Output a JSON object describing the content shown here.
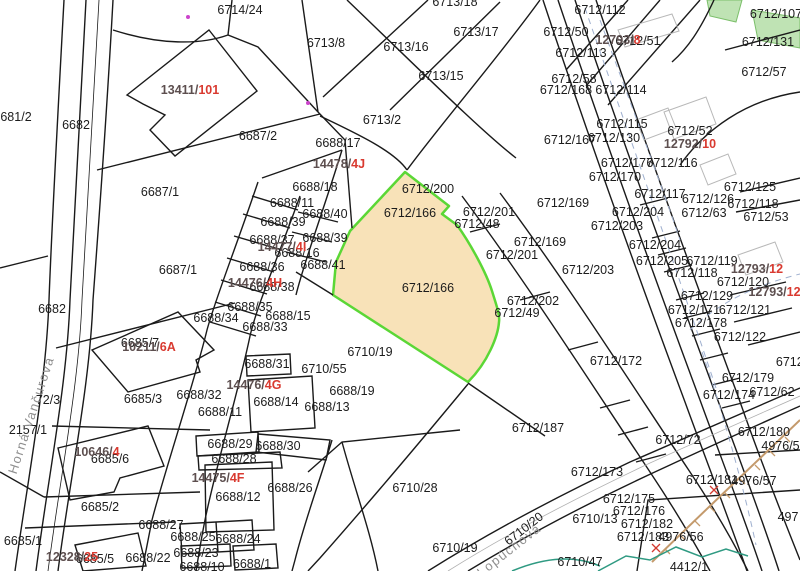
{
  "map": {
    "type": "cadastral-map",
    "highlighted_parcel": {
      "number": "6712/166",
      "fill": "#f8e2b8",
      "border": "#5bd736"
    },
    "colors": {
      "parcel_label": "#1c1c1c",
      "building_label_prefix": "#5d4f4f",
      "building_label_suffix": "#d93a30",
      "street_label": "#8f8f8f",
      "boundary_line": "#1a1a1a",
      "vegetation_fill": "#bfe3b4",
      "road_marking": "#9fb0cf",
      "slope_line": "#c49a6c",
      "utility_line": "#2f9a82"
    },
    "streets": [
      {
        "name": "Horná Vančurova",
        "x": 31,
        "y": 415,
        "rot": -72
      },
      {
        "name": "Lopúchová",
        "x": 509,
        "y": 550,
        "rot": -38
      }
    ],
    "parcel_labels": [
      {
        "text": "6714/24",
        "x": 240,
        "y": 10
      },
      {
        "text": "681/2",
        "x": 16,
        "y": 117
      },
      {
        "text": "6682",
        "x": 76,
        "y": 125
      },
      {
        "text": "6682",
        "x": 52,
        "y": 309
      },
      {
        "text": "6687/2",
        "x": 258,
        "y": 136
      },
      {
        "text": "6687/1",
        "x": 160,
        "y": 192
      },
      {
        "text": "6687/1",
        "x": 178,
        "y": 270
      },
      {
        "text": "6713/8",
        "x": 326,
        "y": 43
      },
      {
        "text": "6713/16",
        "x": 406,
        "y": 47
      },
      {
        "text": "6713/17",
        "x": 476,
        "y": 32
      },
      {
        "text": "6713/15",
        "x": 441,
        "y": 76
      },
      {
        "text": "6713/2",
        "x": 382,
        "y": 120
      },
      {
        "text": "6713/18",
        "x": 455,
        "y": 2
      },
      {
        "text": "6688/17",
        "x": 338,
        "y": 143
      },
      {
        "text": "6688/18",
        "x": 315,
        "y": 187
      },
      {
        "text": "6688/11",
        "x": 292,
        "y": 203
      },
      {
        "text": "6688/40",
        "x": 325,
        "y": 214
      },
      {
        "text": "6688/39",
        "x": 283,
        "y": 222
      },
      {
        "text": "6688/37",
        "x": 272,
        "y": 240
      },
      {
        "text": "6688/39",
        "x": 325,
        "y": 238
      },
      {
        "text": "6688/16",
        "x": 297,
        "y": 253
      },
      {
        "text": "6688/36",
        "x": 262,
        "y": 267
      },
      {
        "text": "6688/41",
        "x": 323,
        "y": 265
      },
      {
        "text": "6688/38",
        "x": 272,
        "y": 287
      },
      {
        "text": "6688/35",
        "x": 250,
        "y": 307
      },
      {
        "text": "6688/34",
        "x": 216,
        "y": 318
      },
      {
        "text": "6688/15",
        "x": 288,
        "y": 316
      },
      {
        "text": "6688/33",
        "x": 265,
        "y": 327
      },
      {
        "text": "6712/200",
        "x": 428,
        "y": 189
      },
      {
        "text": "6712/166",
        "x": 410,
        "y": 213
      },
      {
        "text": "6712/166",
        "x": 428,
        "y": 288
      },
      {
        "text": "6712/167",
        "x": 570,
        "y": 140
      },
      {
        "text": "6712/201",
        "x": 489,
        "y": 212
      },
      {
        "text": "6712/48",
        "x": 477,
        "y": 224
      },
      {
        "text": "6712/169",
        "x": 563,
        "y": 203
      },
      {
        "text": "6712/169",
        "x": 540,
        "y": 242
      },
      {
        "text": "6712/201",
        "x": 512,
        "y": 255
      },
      {
        "text": "6712/203",
        "x": 617,
        "y": 226
      },
      {
        "text": "6712/203",
        "x": 588,
        "y": 270
      },
      {
        "text": "6712/202",
        "x": 533,
        "y": 301
      },
      {
        "text": "6712/49",
        "x": 517,
        "y": 313
      },
      {
        "text": "6712/112",
        "x": 600,
        "y": 10
      },
      {
        "text": "6712/107",
        "x": 776,
        "y": 14
      },
      {
        "text": "6712/50",
        "x": 566,
        "y": 32
      },
      {
        "text": "6712/51",
        "x": 638,
        "y": 41
      },
      {
        "text": "6712/113",
        "x": 581,
        "y": 53
      },
      {
        "text": "6712/131",
        "x": 768,
        "y": 42
      },
      {
        "text": "6712/58",
        "x": 574,
        "y": 79
      },
      {
        "text": "6712/168",
        "x": 566,
        "y": 90
      },
      {
        "text": "6712/114",
        "x": 621,
        "y": 90
      },
      {
        "text": "6712/57",
        "x": 764,
        "y": 72
      },
      {
        "text": "6712/115",
        "x": 622,
        "y": 124
      },
      {
        "text": "6712/130",
        "x": 614,
        "y": 138
      },
      {
        "text": "6712/52",
        "x": 690,
        "y": 131
      },
      {
        "text": "6712/177",
        "x": 627,
        "y": 163
      },
      {
        "text": "6712/116",
        "x": 672,
        "y": 163
      },
      {
        "text": "6712/170",
        "x": 615,
        "y": 177
      },
      {
        "text": "6712/117",
        "x": 660,
        "y": 194
      },
      {
        "text": "6712/125",
        "x": 750,
        "y": 187
      },
      {
        "text": "6712/126",
        "x": 708,
        "y": 199
      },
      {
        "text": "6712/118",
        "x": 753,
        "y": 204
      },
      {
        "text": "6712/53",
        "x": 766,
        "y": 217
      },
      {
        "text": "6712/63",
        "x": 704,
        "y": 213
      },
      {
        "text": "6712/204",
        "x": 638,
        "y": 212
      },
      {
        "text": "6712/204",
        "x": 655,
        "y": 245
      },
      {
        "text": "6712/205",
        "x": 662,
        "y": 261
      },
      {
        "text": "6712/119",
        "x": 712,
        "y": 261
      },
      {
        "text": "6712/118",
        "x": 692,
        "y": 273
      },
      {
        "text": "6712/120",
        "x": 743,
        "y": 282
      },
      {
        "text": "6712/129",
        "x": 707,
        "y": 296
      },
      {
        "text": "6712/171",
        "x": 694,
        "y": 310
      },
      {
        "text": "6712/121",
        "x": 745,
        "y": 310
      },
      {
        "text": "6712/178",
        "x": 701,
        "y": 323
      },
      {
        "text": "6712/122",
        "x": 740,
        "y": 337
      },
      {
        "text": "6712/172",
        "x": 616,
        "y": 361
      },
      {
        "text": "6712/1",
        "x": 795,
        "y": 362
      },
      {
        "text": "6712/179",
        "x": 748,
        "y": 378
      },
      {
        "text": "6712/174",
        "x": 729,
        "y": 395
      },
      {
        "text": "6712/62",
        "x": 772,
        "y": 392
      },
      {
        "text": "6712/187",
        "x": 538,
        "y": 428
      },
      {
        "text": "6712/72",
        "x": 678,
        "y": 440
      },
      {
        "text": "6712/180",
        "x": 764,
        "y": 432
      },
      {
        "text": "4976/58",
        "x": 784,
        "y": 446
      },
      {
        "text": "6712/181",
        "x": 712,
        "y": 480
      },
      {
        "text": "4976/57",
        "x": 754,
        "y": 481
      },
      {
        "text": "6712/173",
        "x": 597,
        "y": 472
      },
      {
        "text": "6712/175",
        "x": 629,
        "y": 499
      },
      {
        "text": "6712/176",
        "x": 639,
        "y": 511
      },
      {
        "text": "6712/182",
        "x": 647,
        "y": 524
      },
      {
        "text": "6712/183",
        "x": 643,
        "y": 537
      },
      {
        "text": "4976/56",
        "x": 681,
        "y": 537
      },
      {
        "text": "497",
        "x": 788,
        "y": 517
      },
      {
        "text": "6710/13",
        "x": 595,
        "y": 519
      },
      {
        "text": "6710/47",
        "x": 580,
        "y": 562
      },
      {
        "text": "6710/28",
        "x": 415,
        "y": 488
      },
      {
        "text": "6710/19",
        "x": 370,
        "y": 352
      },
      {
        "text": "6710/19",
        "x": 455,
        "y": 548
      },
      {
        "text": "6710/55",
        "x": 324,
        "y": 369
      },
      {
        "text": "6710/20",
        "x": 524,
        "y": 529,
        "rot": -38
      },
      {
        "text": "6688/19",
        "x": 352,
        "y": 391
      },
      {
        "text": "6688/13",
        "x": 327,
        "y": 407
      },
      {
        "text": "6688/14",
        "x": 276,
        "y": 402
      },
      {
        "text": "6688/31",
        "x": 267,
        "y": 364
      },
      {
        "text": "6688/11",
        "x": 220,
        "y": 412
      },
      {
        "text": "6688/32",
        "x": 199,
        "y": 395
      },
      {
        "text": "6685/3",
        "x": 143,
        "y": 399
      },
      {
        "text": "6685/7",
        "x": 140,
        "y": 343
      },
      {
        "text": "6685/6",
        "x": 110,
        "y": 459
      },
      {
        "text": "6685/2",
        "x": 100,
        "y": 507
      },
      {
        "text": "6685/1",
        "x": 23,
        "y": 541
      },
      {
        "text": "6685/5",
        "x": 95,
        "y": 559
      },
      {
        "text": "72/3",
        "x": 48,
        "y": 400
      },
      {
        "text": "2157/1",
        "x": 28,
        "y": 430
      },
      {
        "text": "6688/29",
        "x": 230,
        "y": 444
      },
      {
        "text": "6688/30",
        "x": 278,
        "y": 446
      },
      {
        "text": "6688/28",
        "x": 234,
        "y": 459
      },
      {
        "text": "6688/12",
        "x": 238,
        "y": 497
      },
      {
        "text": "6688/26",
        "x": 290,
        "y": 488
      },
      {
        "text": "6688/27",
        "x": 161,
        "y": 525
      },
      {
        "text": "6688/25",
        "x": 193,
        "y": 537
      },
      {
        "text": "6688/24",
        "x": 238,
        "y": 539
      },
      {
        "text": "6688/23",
        "x": 196,
        "y": 553
      },
      {
        "text": "6688/22",
        "x": 148,
        "y": 558
      },
      {
        "text": "6688/1",
        "x": 252,
        "y": 564
      },
      {
        "text": "6688/10",
        "x": 202,
        "y": 567
      },
      {
        "text": "4412/1",
        "x": 689,
        "y": 567
      }
    ],
    "building_labels": [
      {
        "prefix": "13411/",
        "suffix": "101",
        "x": 190,
        "y": 90
      },
      {
        "prefix": "14478/",
        "suffix": "4J",
        "x": 339,
        "y": 164
      },
      {
        "prefix": "14477/",
        "suffix": "4I",
        "x": 282,
        "y": 247
      },
      {
        "prefix": "14476/",
        "suffix": "4H",
        "x": 255,
        "y": 283
      },
      {
        "prefix": "14476/",
        "suffix": "4G",
        "x": 254,
        "y": 385
      },
      {
        "prefix": "14475/",
        "suffix": "4F",
        "x": 218,
        "y": 478
      },
      {
        "prefix": "10211/",
        "suffix": "6A",
        "x": 149,
        "y": 347
      },
      {
        "prefix": "10646/",
        "suffix": "4",
        "x": 97,
        "y": 452
      },
      {
        "prefix": "12328/",
        "suffix": "25",
        "x": 72,
        "y": 557
      },
      {
        "prefix": "12792/",
        "suffix": "10",
        "x": 690,
        "y": 144
      },
      {
        "prefix": "12793/",
        "suffix": "8",
        "x": 618,
        "y": 40
      },
      {
        "prefix": "12793/",
        "suffix": "12",
        "x": 757,
        "y": 269
      },
      {
        "prefix": "12793/",
        "suffix": "12A",
        "x": 779,
        "y": 292
      }
    ]
  }
}
